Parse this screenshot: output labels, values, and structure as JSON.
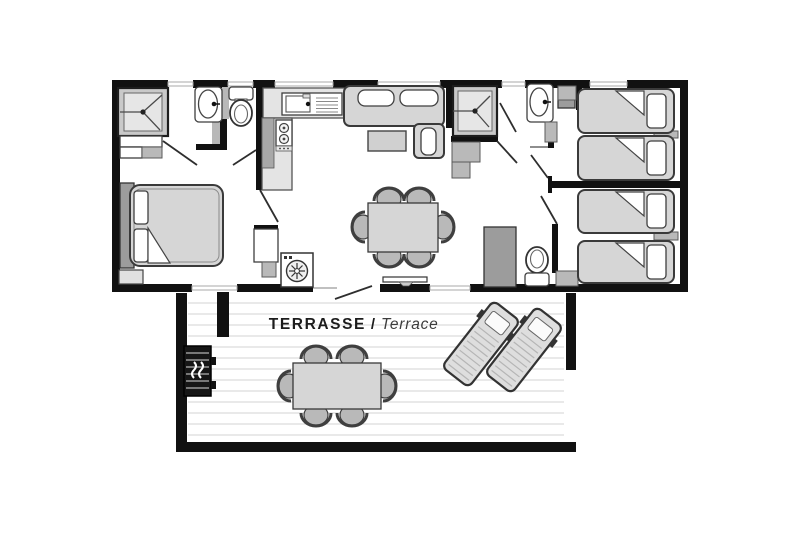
{
  "terrace": {
    "label_primary": "TERRASSE",
    "label_separator": "/",
    "label_secondary": "Terrace"
  },
  "colors": {
    "wall": "#111111",
    "furniture_light": "#d6d6d6",
    "furniture_mid": "#b9b9b9",
    "cabinet_dark": "#9c9c9c",
    "outline": "#3a3a3a",
    "deck_line": "#e2e2e2",
    "background": "#ffffff",
    "text_primary": "#1c1c1c",
    "text_secondary": "#3c3c3c"
  },
  "furniture_items": [
    "double-bed",
    "wardrobe",
    "shower",
    "washbasin",
    "toilet",
    "kitchen-sink",
    "stove",
    "washing-machine",
    "sofa",
    "coffee-table",
    "dining-table-with-6-chairs",
    "tv-unit",
    "tall-cabinet",
    "shower-2",
    "washbasin-2",
    "toilet-2",
    "single-bed-1",
    "single-bed-2",
    "single-bed-3",
    "single-bed-4",
    "terrace-decking",
    "terrace-table-with-6-chairs",
    "sun-lounger-1",
    "sun-lounger-2",
    "barbecue-grill"
  ]
}
